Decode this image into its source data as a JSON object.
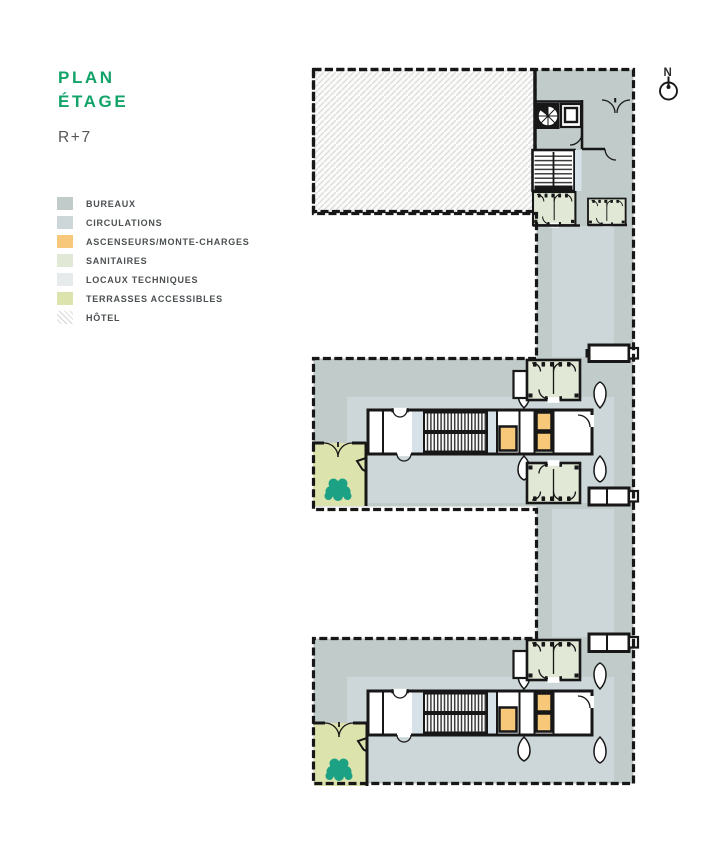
{
  "title": {
    "line1": "PLAN",
    "line2": "ÉTAGE",
    "level": "R+7"
  },
  "compass": {
    "label": "N"
  },
  "legend": {
    "items": [
      {
        "label": "BUREAUX",
        "color_key": "bureaux",
        "style": "fill"
      },
      {
        "label": "CIRCULATIONS",
        "color_key": "circulations",
        "style": "fill"
      },
      {
        "label": "ASCENSEURS/MONTE-CHARGES",
        "color_key": "ascenseurs",
        "style": "fill"
      },
      {
        "label": "SANITAIRES",
        "color_key": "sanitaires",
        "style": "fill"
      },
      {
        "label": "LOCAUX TECHNIQUES",
        "color_key": "locaux",
        "style": "fill"
      },
      {
        "label": "TERRASSES ACCESSIBLES",
        "color_key": "terrasses",
        "style": "fill"
      },
      {
        "label": "HÔTEL",
        "color_key": "hotel_hatch",
        "style": "hatch"
      }
    ]
  },
  "colors": {
    "accent": "#12a368",
    "bureaux": "#c0cbca",
    "circulations": "#cdd7d9",
    "ascenseurs": "#f7c87a",
    "sanitaires": "#e1e9d6",
    "locaux": "#e7eaea",
    "terrasses": "#dce3ac",
    "hotel_hatch": "#dcdedd",
    "tree": "#1ca185",
    "water": "#d6e2e8",
    "wall": "#171717"
  }
}
